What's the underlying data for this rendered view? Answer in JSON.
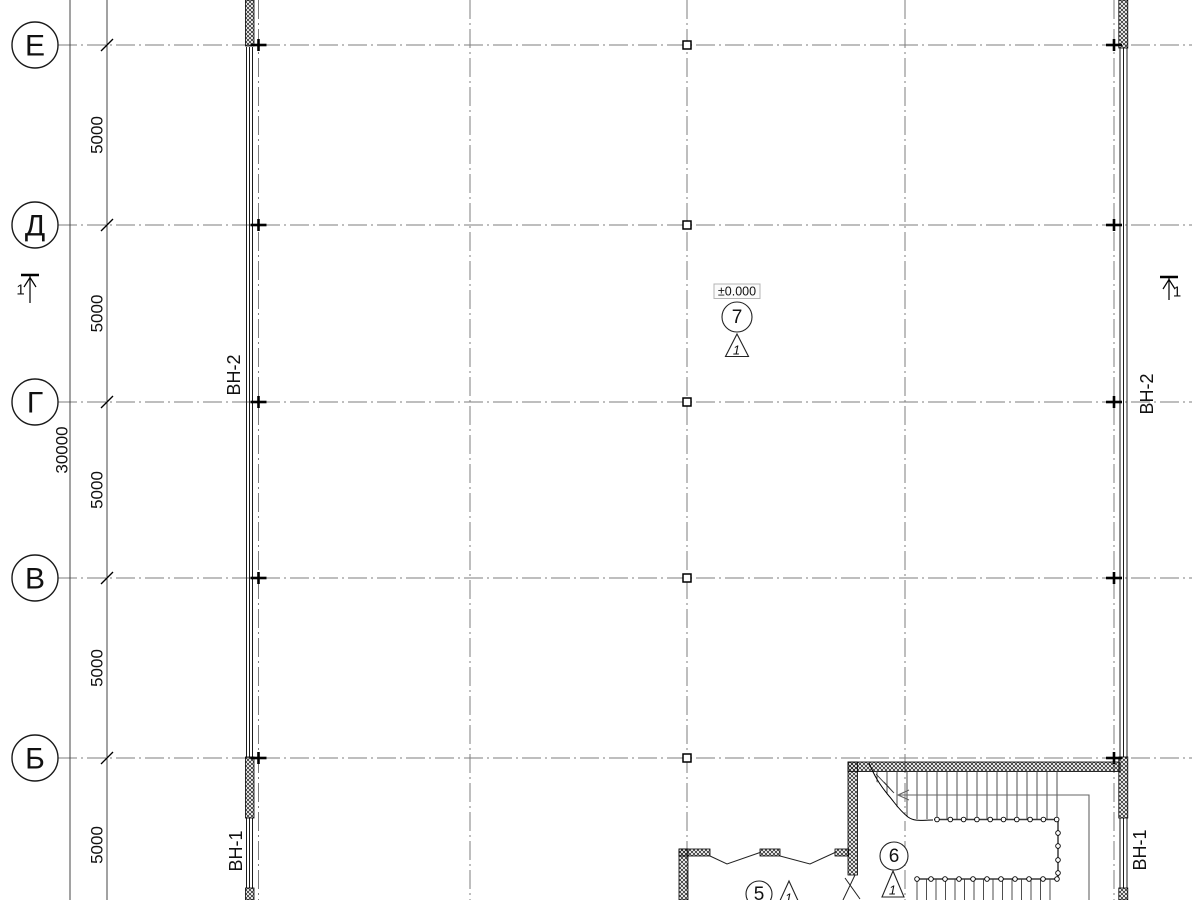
{
  "plan": {
    "grid": {
      "row_labels": [
        "Е",
        "Д",
        "Г",
        "В",
        "Б"
      ]
    },
    "dimensions": {
      "bay_mm": "5000",
      "total_mm": "30000"
    },
    "wall_tags": {
      "upper_band": "ВН-2",
      "lower_band": "ВН-1"
    },
    "level_mark": "±0.000",
    "section_mark_label": "1",
    "rooms": [
      {
        "number": "7",
        "zone_triangle": "1"
      },
      {
        "number": "6",
        "zone_triangle": "1"
      },
      {
        "number": "5",
        "zone_triangle": "1"
      }
    ]
  },
  "colors": {
    "ink": "#1a1a1a",
    "axis_gray": "#7d7d7d",
    "rail_gray": "#555555"
  }
}
